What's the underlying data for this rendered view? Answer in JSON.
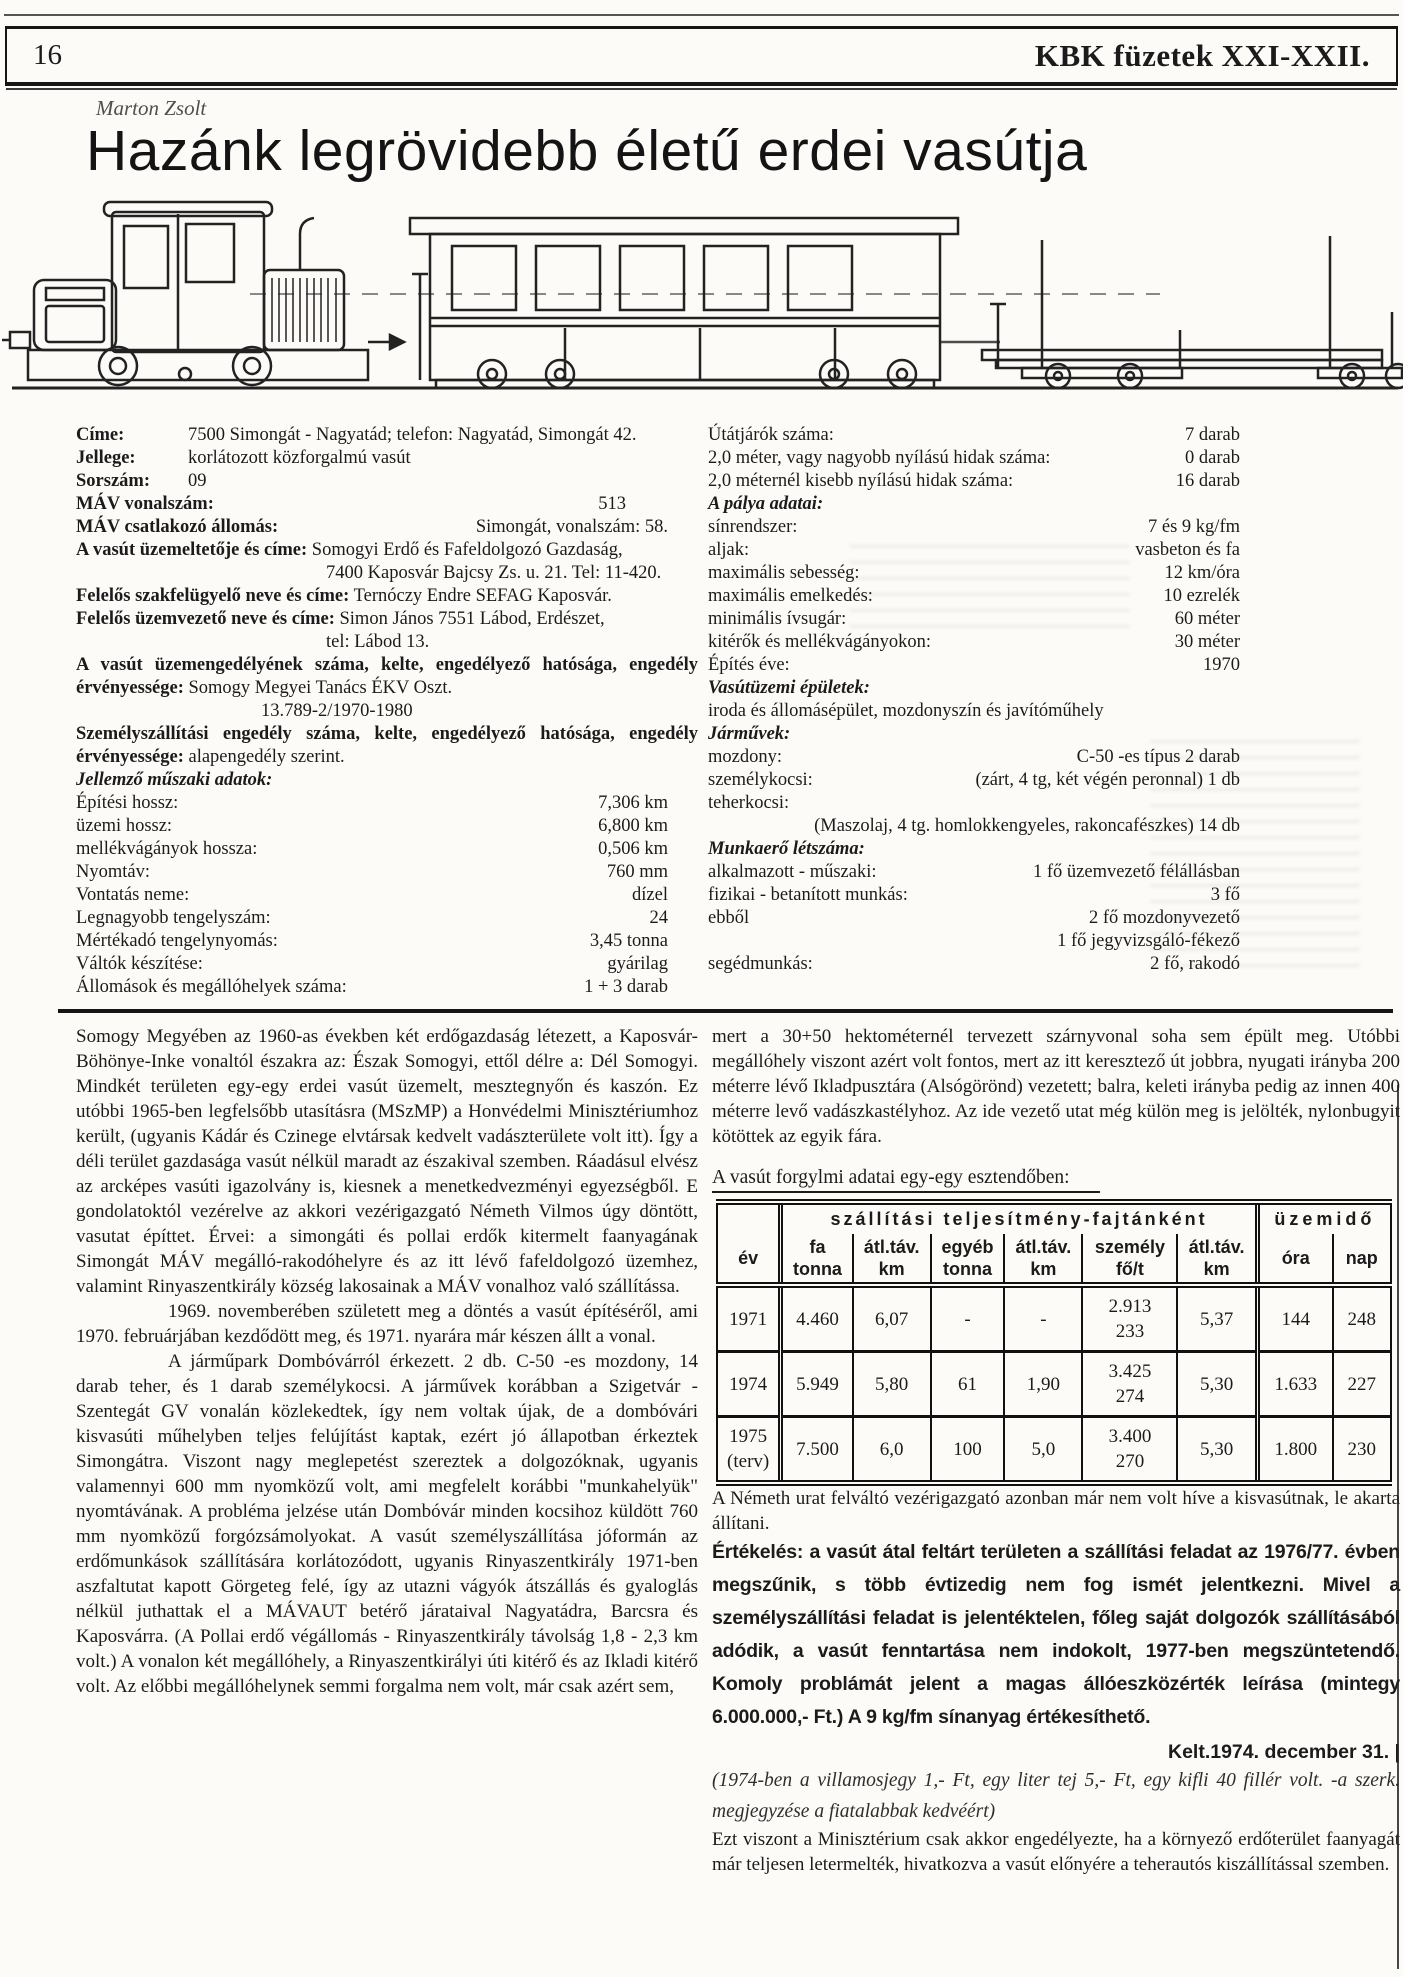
{
  "header": {
    "page_number": "16",
    "issue_title": "KBK füzetek XXI-XXII."
  },
  "byline": "Marton Zsolt",
  "title": "Hazánk legrövidebb életű erdei vasútja",
  "data_sheet": {
    "left": {
      "rows": [
        {
          "label": "Címe:",
          "value": "7500 Simongát - Nagyatád; telefon: Nagyatád, Simongát 42."
        },
        {
          "label": "Jellege:",
          "value": "korlátozott közforgalmú vasút"
        },
        {
          "label": "Sorszám:",
          "value": "09"
        },
        {
          "label": "MÁV vonalszám:",
          "value": "513"
        },
        {
          "label": "MÁV csatlakozó állomás:",
          "value": "Simongát, vonalszám: 58."
        },
        {
          "label": "A vasút üzemeltetője és címe:",
          "value": "Somogyi Erdő és Fafeldolgozó Gazdaság,",
          "value2": "7400 Kaposvár Bajcsy Zs. u. 21. Tel: 11-420."
        },
        {
          "label": "Felelős szakfelügyelő neve és címe:",
          "value": "Ternóczy Endre SEFAG Kaposvár."
        },
        {
          "label": "Felelős üzemvezető neve és címe:",
          "value": "Simon János 7551 Lábod, Erdészet,",
          "value2": "tel: Lábod 13."
        },
        {
          "label": "A vasút üzemengedélyének száma, kelte, engedélyező hatósága, engedély érvényessége:",
          "value": "Somogy Megyei Tanács ÉKV Oszt.",
          "value2": "13.789-2/1970-1980"
        },
        {
          "label": "Személyszállítási engedély száma, kelte, engedélyező hatósága, engedély érvényessége:",
          "value": "alapengedély szerint."
        }
      ],
      "tech_heading": "Jellemző műszaki adatok:",
      "tech_rows": [
        {
          "label": "Építési hossz:",
          "value": "7,306 km"
        },
        {
          "label": "üzemi hossz:",
          "value": "6,800 km"
        },
        {
          "label": "mellékvágányok hossza:",
          "value": "0,506 km"
        },
        {
          "label": "Nyomtáv:",
          "value": "760 mm"
        },
        {
          "label": "Vontatás neme:",
          "value": "dízel"
        },
        {
          "label": "Legnagyobb tengelyszám:",
          "value": "24"
        },
        {
          "label": "Mértékadó tengelynyomás:",
          "value": "3,45 tonna"
        },
        {
          "label": "Váltók készítése:",
          "value": "gyárilag"
        },
        {
          "label": "Állomások és megállóhelyek száma:",
          "value": "1 + 3 darab"
        }
      ]
    },
    "right": {
      "rows": [
        {
          "label": "Útátjárók száma:",
          "value": "7 darab"
        },
        {
          "label": "2,0 méter, vagy nagyobb nyílású hidak száma:",
          "value": "0 darab"
        },
        {
          "label": "2,0 méternél kisebb nyílású hidak száma:",
          "value": "16 darab"
        }
      ],
      "track_heading": "A pálya adatai:",
      "track_rows": [
        {
          "label": "sínrendszer:",
          "value": "7 és 9 kg/fm"
        },
        {
          "label": "aljak:",
          "value": "vasbeton és fa"
        },
        {
          "label": "maximális sebesség:",
          "value": "12 km/óra"
        },
        {
          "label": "maximális emelkedés:",
          "value": "10 ezrelék"
        },
        {
          "label": "minimális ívsugár:",
          "value": "60 méter"
        },
        {
          "label": "kitérők és mellékvágányokon:",
          "value": "30 méter"
        },
        {
          "label": "Építés éve:",
          "value": "1970"
        }
      ],
      "buildings_heading": "Vasútüzemi épületek:",
      "buildings_value": "iroda és állomásépület, mozdonyszín és javítóműhely",
      "vehicles_heading": "Járművek:",
      "vehicles_rows": [
        {
          "label": "mozdony:",
          "value": "C-50 -es típus 2 darab"
        },
        {
          "label": "személykocsi:",
          "value": "(zárt, 4 tg, két végén peronnal) 1 db"
        },
        {
          "label": "teherkocsi:",
          "value": ""
        },
        {
          "label": "",
          "value": "(Maszolaj, 4 tg. homlokkengyeles, rakoncafészkes) 14 db"
        }
      ],
      "staff_heading": "Munkaerő létszáma:",
      "staff_rows": [
        {
          "label": "alkalmazott - műszaki:",
          "value": "1 fő üzemvezető félállásban"
        },
        {
          "label": "fizikai - betanított munkás:",
          "value": "3 fő"
        },
        {
          "label": "ebből",
          "value": "2 fő mozdonyvezető"
        },
        {
          "label": "",
          "value": "1 fő jegyvizsgáló-fékező"
        },
        {
          "label": "segédmunkás:",
          "value": "2 fő, rakodó"
        }
      ]
    }
  },
  "body": {
    "left_paragraphs": [
      "Somogy Megyében az 1960-as években két erdőgazdaság létezett, a Kaposvár-Böhönye-Inke vonaltól északra az: Észak Somogyi, ettől délre a: Dél Somogyi. Mindkét területen egy-egy erdei vasút üzemelt, mesztegnyőn és kaszón. Ez utóbbi 1965-ben legfelsőbb utasításra (MSzMP) a Honvédelmi Minisztériumhoz került, (ugyanis Kádár és Czinege elvtársak kedvelt vadászterülete volt itt). Így a déli terület gazdasága vasút nélkül maradt az északival szemben. Ráadásul elvész az arcképes vasúti igazolvány is, kiesnek a menetkedvezményi egyezségből. E gondolatoktól vezérelve az akkori vezérigazgató Németh Vilmos úgy döntött, vasutat építtet. Érvei: a simongáti és pollai erdők kitermelt faanyagának Simongát MÁV megálló-rakodóhelyre és az itt lévő fafeldolgozó üzemhez, valamint Rinyaszentkirály község lakosainak a MÁV vonalhoz való szállítássa.",
      "1969. novemberében született meg a döntés a vasút építéséről, ami 1970. februárjában kezdődött meg, és 1971. nyarára már készen állt a vonal.",
      "A járműpark Dombóvárról érkezett. 2 db. C-50 -es mozdony, 14 darab teher, és 1 darab személykocsi. A járművek korábban a Szigetvár - Szentegát GV vonalán közlekedtek, így nem voltak újak, de a dombóvári kisvasúti műhelyben teljes felújítást kaptak, ezért jó állapotban érkeztek Simongátra. Viszont nagy meglepetést szereztek a dolgozóknak, ugyanis valamennyi 600 mm nyomközű volt, ami megfelelt korábbi \"munkahelyük\" nyomtávának. A probléma jelzése után Dombóvár minden kocsihoz küldött 760 mm nyomközű forgózsámolyokat. A vasút személyszállítása jóformán az erdőmunkások szállítására korlátozódott, ugyanis Rinyaszentkirály 1971-ben aszfaltutat kapott Görgeteg felé, így az utazni vágyók átszállás és gyaloglás nélkül juthattak el a MÁVAUT betérő járataival Nagyatádra, Barcsra és Kaposvárra. (A Pollai erdő végállomás - Rinyaszentkirály távolság 1,8 - 2,3 km volt.) A vonalon két megállóhely, a Rinyaszentkirályi úti kitérő és az Ikladi kitérő volt. Az előbbi megállóhelynek semmi forgalma nem volt, már csak azért sem,",
      "mert a 30+50 hektométernél tervezett szárnyvonal soha sem épült meg. Utóbbi megállóhely viszont azért volt fontos, mert az itt keresztező út jobbra, nyugati irányba 200 méterre lévő Ikladpusztára (Alsógörönd) vezetett; balra, keleti irányba pedig az innen 400 méterre levő vadászkastélyhoz. Az ide vezető utat még külön meg is jelölték, nylonbugyit kötöttek az egyik fára."
    ],
    "table_caption": "A vasút forgylmi adatai egy-egy esztendőben:",
    "after_table": "A Németh urat felváltó vezérigazgató azonban már nem volt híve a kisvasútnak, le akarta állítani.",
    "evaluation": "Értékelés: a vasút átal feltárt területen a szállítási feladat az 1976/77. évben megszűnik, s több évtizedig nem fog ismét jelentkezni. Mivel a személyszállítási feladat is jelentéktelen, főleg saját dolgozók szállításából adódik, a vasút fenntartása nem indokolt, 1977-ben megszüntetendő. Komoly problámát jelent a magas állóeszközérték leírása (mintegy 6.000.000,- Ft.)  A 9 kg/fm sínanyag értékesíthető.",
    "dateline": "Kelt.1974. december 31. |",
    "editors_note": "(1974-ben a villamosjegy 1,- Ft, egy liter tej 5,- Ft, egy kifli 40 fillér volt. -a szerk. megjegyzése a fiatalabbak kedvéért)",
    "closing": "Ezt viszont a Minisztérium csak akkor engedélyezte, ha a környező erdőterület faanyagát már teljesen letermelték, hivatkozva a vasút előnyére a teherautós kiszállítással szemben."
  },
  "traffic_table": {
    "group_headers": [
      "szállítási teljesítmény-fajtánként",
      "üzemidő"
    ],
    "columns": [
      "év",
      "fa\ntonna",
      "átl.táv.\nkm",
      "egyéb\ntonna",
      "átl.táv.\nkm",
      "személy\nfő/t",
      "átl.táv.\nkm",
      "óra",
      "nap"
    ],
    "rows": [
      [
        "1971",
        "4.460",
        "6,07",
        "-",
        "-",
        "2.913\n233",
        "5,37",
        "144",
        "248"
      ],
      [
        "1974",
        "5.949",
        "5,80",
        "61",
        "1,90",
        "3.425\n274",
        "5,30",
        "1.633",
        "227"
      ],
      [
        "1975\n(terv)",
        "7.500",
        "6,0",
        "100",
        "5,0",
        "3.400\n270",
        "5,30",
        "1.800",
        "230"
      ]
    ]
  },
  "colors": {
    "ink": "#1b1b1b",
    "paper": "#fcfbf8"
  }
}
